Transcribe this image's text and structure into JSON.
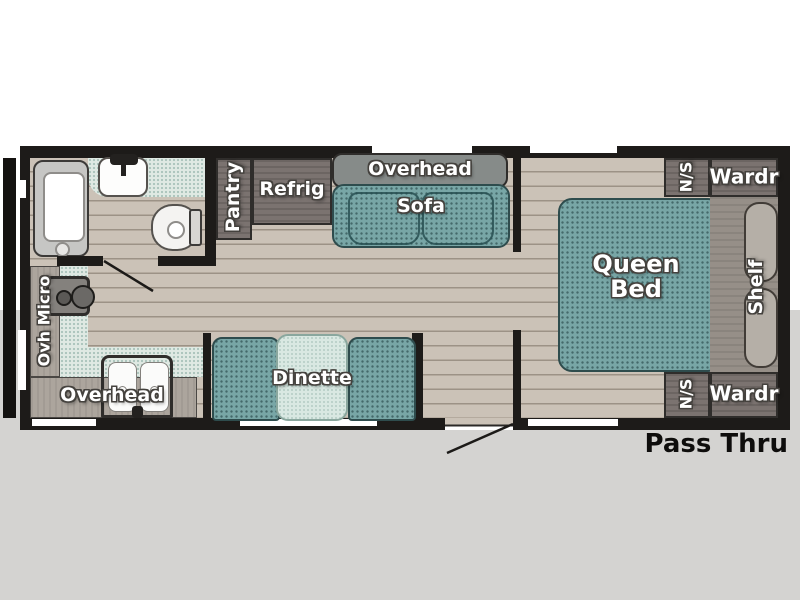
{
  "plan": {
    "title_note": "Pass Thru",
    "bathroom": {
      "fixtures": [
        "shower",
        "sink",
        "toilet"
      ]
    },
    "kitchen": {
      "range_hood_label": "Ovh Micro",
      "overhead_label": "Overhead"
    },
    "pantry_label": "Pantry",
    "refrigerator_label": "Refrig",
    "sofa": {
      "overhead_label": "Overhead",
      "label": "Sofa"
    },
    "dinette_label": "Dinette",
    "bedroom": {
      "bed_label": "Queen Bed",
      "nightstand_top_label": "N/S",
      "wardrobe_top_label": "Wardr",
      "shelf_label": "Shelf",
      "nightstand_bottom_label": "N/S",
      "wardrobe_bottom_label": "Wardr"
    },
    "pass_thru_label": "Pass Thru",
    "colors": {
      "wall_black": "#1d1b19",
      "floor_tan": "#cbc2b7",
      "upholstery_teal": "#78a6a6",
      "counter_mint": "#dfe9e3",
      "cabinet_wood": "#7b7370",
      "shelf_wood": "#968f88",
      "background_gray": "#d4d3d1"
    }
  }
}
